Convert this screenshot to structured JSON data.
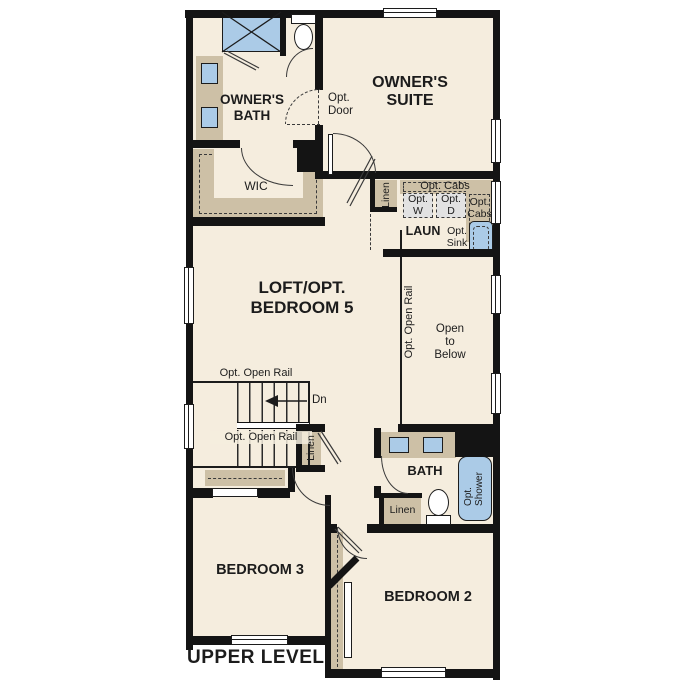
{
  "title": "UPPER LEVEL",
  "rooms": {
    "owners_bath": "OWNER'S\nBATH",
    "owners_suite": "OWNER'S\nSUITE",
    "wic": "WIC",
    "laundry": "LAUN",
    "loft": "LOFT/OPT.\nBEDROOM 5",
    "open_to_below": "Open\nto\nBelow",
    "bath": "BATH",
    "bedroom3": "BEDROOM 3",
    "bedroom2": "BEDROOM 2"
  },
  "annotations": {
    "opt_door": "Opt.\nDoor",
    "linen_laundry": "Linen",
    "opt_cabs_top": "Opt. Cabs",
    "opt_washer": "Opt.\nW",
    "opt_dryer": "Opt.\nD",
    "opt_cabs_side": "Opt.\nCabs",
    "opt_sink": "Opt.\nSink",
    "opt_open_rail_mid": "Opt. Open Rail",
    "opt_open_rail_top": "Opt. Open Rail",
    "opt_open_rail_bottom": "Opt. Open Rail",
    "down": "Dn",
    "linen_hall": "Linen",
    "opt_shower": "Opt.\nShower",
    "linen_bath": "Linen"
  },
  "colors": {
    "floor": "#f5edde",
    "cabinet": "#cdc0a6",
    "fixture_blue": "#abcbe7",
    "wall": "#141414",
    "appliance_gray": "#e2e2e2"
  }
}
